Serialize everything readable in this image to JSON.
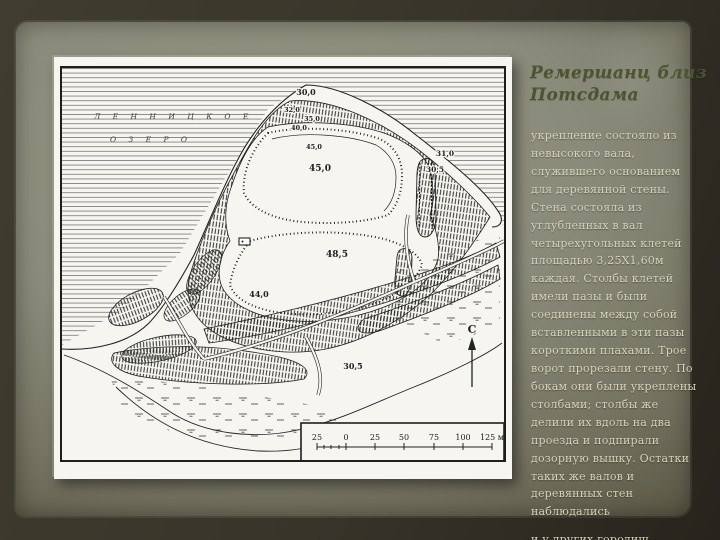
{
  "title": {
    "line1": "Ремершанц близ",
    "line2": "Потсдама"
  },
  "body": {
    "paragraph1": "укрепление состояло из невысокого вала, служившего основанием для деревянной стены. Стена состояла из углубленных в вал четырехугольных клетей площадью 3,25Х1,60м каждая. Столбы клетей имели пазы и были соединены между собой вставленными в эти пазы короткими плахами. Трое ворот прорезали стену. По бокам они были укреплены столбами; столбы же делили их вдоль на два проезда и подпирали дозорную вышку. Остатки таких же валов и деревянных стен наблюдались",
    "paragraph2": "и у других городищ."
  },
  "map": {
    "lake_name_line1": "Л Е Н Н И Ц К О Е",
    "lake_name_line2": "О З Е Р О",
    "north_label": "С",
    "elevation_labels": [
      "30,0",
      "32,0",
      "35,0",
      "40,0",
      "45,0",
      "45,0",
      "48,5",
      "44,0",
      "31,0",
      "30,5",
      "30,5"
    ],
    "scale_ticks": [
      "25",
      "0",
      "25",
      "50",
      "75",
      "100",
      "125 м"
    ]
  },
  "colors": {
    "title_olive": "#4c5530",
    "body_cream": "#d6d4ba",
    "paper_gray_green": "#8a8b7b",
    "map_paper_white": "#f6f5ef",
    "ink_black": "#1f1f1f"
  }
}
